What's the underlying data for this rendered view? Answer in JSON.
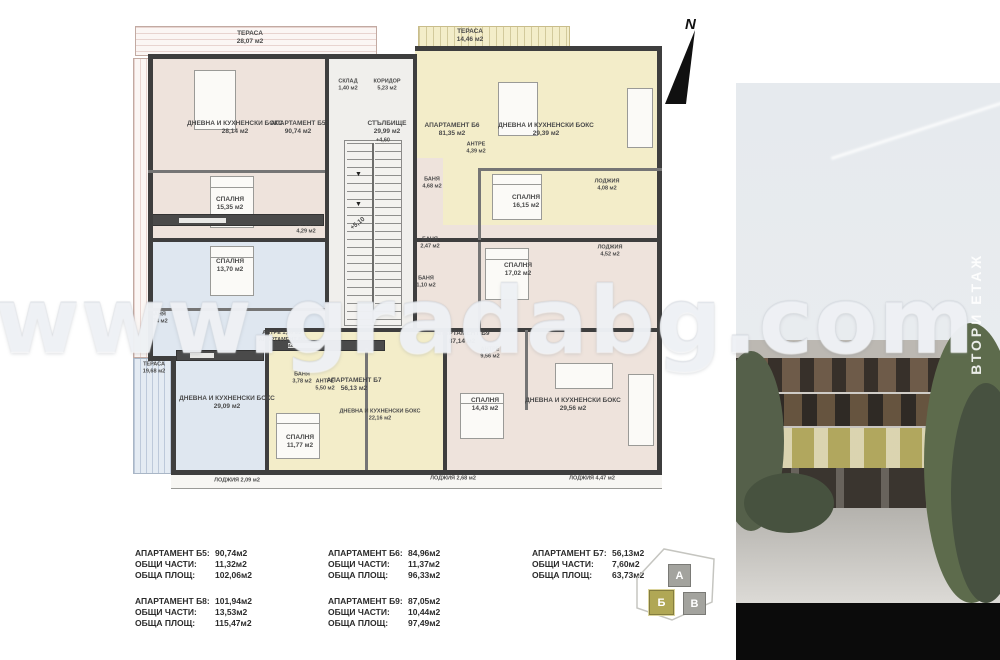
{
  "meta": {
    "compass_label": "N",
    "watermark": "www.gradabg.com",
    "floor_label": "ВТОРИ ЕТАЖ"
  },
  "plan": {
    "colors": {
      "pink": "#eee3dc",
      "yellow": "#f3edc9",
      "blue": "#dfe7f0",
      "core": "#f0efec",
      "wall": "#3e3e3e"
    },
    "zones": [
      {
        "x": 20,
        "y": 38,
        "w": 178,
        "h": 184,
        "fill": "#eee3dc"
      },
      {
        "x": 285,
        "y": 30,
        "w": 247,
        "h": 192,
        "fill": "#f3edc9"
      },
      {
        "x": 20,
        "y": 222,
        "w": 175,
        "h": 118,
        "fill": "#dfe7f0"
      },
      {
        "x": 44,
        "y": 340,
        "w": 91,
        "h": 112,
        "fill": "#dfe7f0"
      },
      {
        "x": 135,
        "y": 312,
        "w": 178,
        "h": 140,
        "fill": "#f3edc9"
      },
      {
        "x": 313,
        "y": 207,
        "w": 219,
        "h": 245,
        "fill": "#eee3dc"
      },
      {
        "x": 283,
        "y": 140,
        "w": 30,
        "h": 172,
        "fill": "#eee3dc"
      },
      {
        "x": 195,
        "y": 38,
        "w": 90,
        "h": 274,
        "fill": "#f0efec"
      }
    ],
    "terraces": [
      {
        "x": 5,
        "y": 8,
        "w": 240,
        "h": 28,
        "hatch": "pink-h"
      },
      {
        "x": 288,
        "y": 8,
        "w": 150,
        "h": 21,
        "hatch": "yellow"
      },
      {
        "x": 3,
        "y": 40,
        "w": 15,
        "h": 298,
        "hatch": "pink-v"
      },
      {
        "x": 3,
        "y": 340,
        "w": 38,
        "h": 114,
        "hatch": "blue"
      }
    ],
    "loggia_strip": {
      "x": 41,
      "y": 457,
      "w": 491,
      "h": 13
    },
    "walls": [
      {
        "x": 18,
        "y": 36,
        "w": 267,
        "h": 5
      },
      {
        "x": 285,
        "y": 28,
        "w": 247,
        "h": 5
      },
      {
        "x": 527,
        "y": 28,
        "w": 5,
        "h": 429
      },
      {
        "x": 41,
        "y": 452,
        "w": 491,
        "h": 5
      },
      {
        "x": 18,
        "y": 36,
        "w": 5,
        "h": 307
      },
      {
        "x": 41,
        "y": 338,
        "w": 5,
        "h": 119
      },
      {
        "x": 18,
        "y": 338,
        "w": 28,
        "h": 5
      },
      {
        "x": 195,
        "y": 36,
        "w": 4,
        "h": 276
      },
      {
        "x": 283,
        "y": 36,
        "w": 4,
        "h": 276
      },
      {
        "x": 18,
        "y": 220,
        "w": 181,
        "h": 4
      },
      {
        "x": 285,
        "y": 220,
        "w": 247,
        "h": 4
      },
      {
        "x": 135,
        "y": 310,
        "w": 397,
        "h": 4
      },
      {
        "x": 313,
        "y": 310,
        "w": 4,
        "h": 147
      },
      {
        "x": 135,
        "y": 310,
        "w": 4,
        "h": 147
      },
      {
        "x": 18,
        "y": 152,
        "w": 177,
        "h": 3,
        "thin": true
      },
      {
        "x": 18,
        "y": 290,
        "w": 177,
        "h": 3,
        "thin": true
      },
      {
        "x": 348,
        "y": 150,
        "w": 184,
        "h": 3,
        "thin": true
      },
      {
        "x": 348,
        "y": 150,
        "w": 3,
        "h": 72,
        "thin": true
      },
      {
        "x": 348,
        "y": 224,
        "w": 3,
        "h": 86,
        "thin": true
      },
      {
        "x": 395,
        "y": 312,
        "w": 3,
        "h": 80,
        "thin": true
      },
      {
        "x": 235,
        "y": 330,
        "w": 3,
        "h": 122,
        "thin": true
      }
    ],
    "stairs": {
      "x": 214,
      "y": 122,
      "w": 58,
      "h": 186
    },
    "furniture": [
      {
        "type": "bed",
        "x": 80,
        "y": 158,
        "w": 44,
        "h": 52
      },
      {
        "type": "bed",
        "x": 80,
        "y": 228,
        "w": 44,
        "h": 50
      },
      {
        "type": "bed",
        "x": 362,
        "y": 156,
        "w": 50,
        "h": 46
      },
      {
        "type": "bed",
        "x": 355,
        "y": 230,
        "w": 44,
        "h": 52
      },
      {
        "type": "bed",
        "x": 330,
        "y": 375,
        "w": 44,
        "h": 46
      },
      {
        "type": "bed",
        "x": 146,
        "y": 395,
        "w": 44,
        "h": 46
      },
      {
        "type": "table",
        "x": 64,
        "y": 52,
        "w": 42,
        "h": 60
      },
      {
        "type": "table",
        "x": 368,
        "y": 64,
        "w": 40,
        "h": 54
      },
      {
        "type": "table",
        "x": 425,
        "y": 345,
        "w": 58,
        "h": 26
      },
      {
        "type": "counter",
        "x": 22,
        "y": 196,
        "w": 172,
        "h": 12
      },
      {
        "type": "counter",
        "x": 46,
        "y": 332,
        "w": 88,
        "h": 11
      },
      {
        "type": "counter",
        "x": 140,
        "y": 322,
        "w": 115,
        "h": 11
      },
      {
        "type": "sofa",
        "x": 497,
        "y": 70,
        "w": 26,
        "h": 60
      },
      {
        "type": "sofa",
        "x": 498,
        "y": 356,
        "w": 26,
        "h": 72
      }
    ],
    "labels": [
      {
        "x": 120,
        "y": 20,
        "lines": [
          "ТЕРАСА",
          "28,07 м2"
        ]
      },
      {
        "x": 340,
        "y": 18,
        "lines": [
          "ТЕРАСА",
          "14,46 м2"
        ]
      },
      {
        "x": 24,
        "y": 350,
        "lines": [
          "ТЕРАСА",
          "19,68 м2"
        ],
        "size": 5.5
      },
      {
        "x": 105,
        "y": 110,
        "lines": [
          "ДНЕВНА И КУХНЕНСКИ БОКС",
          "28,14 м2"
        ]
      },
      {
        "x": 168,
        "y": 110,
        "lines": [
          "АПАРТАМЕНТ Б5",
          "90,74 м2"
        ]
      },
      {
        "x": 100,
        "y": 186,
        "lines": [
          "СПАЛНЯ",
          "15,35 м2"
        ]
      },
      {
        "x": 176,
        "y": 210,
        "lines": [
          "БАНЯ",
          "4,29 м2"
        ],
        "size": 5.5
      },
      {
        "x": 218,
        "y": 67,
        "lines": [
          "СКЛАД",
          "1,40 м2"
        ],
        "size": 5.5
      },
      {
        "x": 257,
        "y": 67,
        "lines": [
          "КОРИДОР",
          "5,23 м2"
        ],
        "size": 5.5
      },
      {
        "x": 257,
        "y": 110,
        "lines": [
          "СТЪЛБИЩЕ",
          "29,99 м2"
        ]
      },
      {
        "x": 253,
        "y": 123,
        "lines": [
          "+4,60"
        ],
        "size": 5.5
      },
      {
        "x": 228,
        "y": 206,
        "lines": [
          "+5,10"
        ],
        "rot": -38
      },
      {
        "x": 322,
        "y": 112,
        "lines": [
          "АПАРТАМЕНТ Б6",
          "81,35 м2"
        ]
      },
      {
        "x": 346,
        "y": 130,
        "lines": [
          "АНТРЕ",
          "4,39 м2"
        ],
        "size": 5.5
      },
      {
        "x": 416,
        "y": 112,
        "lines": [
          "ДНЕВНА И КУХНЕНСКИ БОКС",
          "29,39 м2"
        ]
      },
      {
        "x": 396,
        "y": 184,
        "lines": [
          "СПАЛНЯ",
          "16,15 м2"
        ]
      },
      {
        "x": 302,
        "y": 165,
        "lines": [
          "БАНЯ",
          "4,68 м2"
        ],
        "size": 5.5
      },
      {
        "x": 477,
        "y": 167,
        "lines": [
          "ЛОДЖИЯ",
          "4,08 м2"
        ],
        "size": 5.5
      },
      {
        "x": 388,
        "y": 252,
        "lines": [
          "СПАЛНЯ",
          "17,02 м2"
        ]
      },
      {
        "x": 480,
        "y": 233,
        "lines": [
          "ЛОДЖИЯ",
          "4,52 м2"
        ],
        "size": 5.5
      },
      {
        "x": 300,
        "y": 225,
        "lines": [
          "БАНЯ",
          "2,47 м2"
        ],
        "size": 5.5
      },
      {
        "x": 296,
        "y": 264,
        "lines": [
          "БАНЯ",
          "1,10 м2"
        ],
        "size": 5.5
      },
      {
        "x": 100,
        "y": 248,
        "lines": [
          "СПАЛНЯ",
          "13,70 м2"
        ]
      },
      {
        "x": 28,
        "y": 300,
        "lines": [
          "БАНЯ",
          "3,74 м2"
        ],
        "size": 5.5
      },
      {
        "x": 152,
        "y": 322,
        "lines": [
          "АНТРЕ 1,86 м2",
          "АПАРТАМЕНТ Б8",
          "84,94 м2"
        ],
        "size": 5.5
      },
      {
        "x": 97,
        "y": 385,
        "lines": [
          "ДНЕВНА И КУХНЕНСКИ БОКС",
          "29,09 м2"
        ]
      },
      {
        "x": 107,
        "y": 463,
        "lines": [
          "ЛОДЖИЯ 2,09 м2"
        ],
        "size": 5.5
      },
      {
        "x": 172,
        "y": 360,
        "lines": [
          "БАНЯ",
          "3,78 м2"
        ],
        "size": 5.5
      },
      {
        "x": 195,
        "y": 367,
        "lines": [
          "АНТРЕ",
          "5,50 м2"
        ],
        "size": 5.5
      },
      {
        "x": 224,
        "y": 367,
        "lines": [
          "АПАРТАМЕНТ Б7",
          "56,13 м2"
        ]
      },
      {
        "x": 250,
        "y": 397,
        "lines": [
          "ДНЕВНА И КУХНЕНСКИ БОКС",
          "22,16 м2"
        ],
        "size": 5.5
      },
      {
        "x": 170,
        "y": 424,
        "lines": [
          "СПАЛНЯ",
          "11,77 м2"
        ]
      },
      {
        "x": 323,
        "y": 461,
        "lines": [
          "ЛОДЖИЯ 2,68 м2"
        ],
        "size": 5.5
      },
      {
        "x": 332,
        "y": 320,
        "lines": [
          "АПАРТАМЕНТ Б9",
          "87,14 м2"
        ]
      },
      {
        "x": 360,
        "y": 335,
        "lines": [
          "АНТРЕ",
          "9,56 м2"
        ],
        "size": 5.5
      },
      {
        "x": 355,
        "y": 387,
        "lines": [
          "СПАЛНЯ",
          "14,43 м2"
        ]
      },
      {
        "x": 443,
        "y": 387,
        "lines": [
          "ДНЕВНА И КУХНЕНСКИ БОКС",
          "29,56 м2"
        ]
      },
      {
        "x": 462,
        "y": 461,
        "lines": [
          "ЛОДЖИЯ 4,47 м2"
        ],
        "size": 5.5
      }
    ]
  },
  "tables": [
    {
      "x": 135,
      "y": 548,
      "rows": [
        [
          "АПАРТАМЕНТ Б5:",
          "90,74м2"
        ],
        [
          "ОБЩИ ЧАСТИ:",
          "11,32м2"
        ],
        [
          "ОБЩА ПЛОЩ:",
          "102,06м2"
        ]
      ]
    },
    {
      "x": 328,
      "y": 548,
      "rows": [
        [
          "АПАРТАМЕНТ Б6:",
          "84,96м2"
        ],
        [
          "ОБЩИ ЧАСТИ:",
          "11,37м2"
        ],
        [
          "ОБЩА ПЛОЩ:",
          "96,33м2"
        ]
      ]
    },
    {
      "x": 532,
      "y": 548,
      "rows": [
        [
          "АПАРТАМЕНТ Б7:",
          "56,13м2"
        ],
        [
          "ОБЩИ ЧАСТИ:",
          "7,60м2"
        ],
        [
          "ОБЩА ПЛОЩ:",
          "63,73м2"
        ]
      ]
    },
    {
      "x": 135,
      "y": 596,
      "rows": [
        [
          "АПАРТАМЕНТ Б8:",
          "101,94м2"
        ],
        [
          "ОБЩИ ЧАСТИ:",
          "13,53м2"
        ],
        [
          "ОБЩА ПЛОЩ:",
          "115,47м2"
        ]
      ]
    },
    {
      "x": 328,
      "y": 596,
      "rows": [
        [
          "АПАРТАМЕНТ Б9:",
          "87,05м2"
        ],
        [
          "ОБЩИ ЧАСТИ:",
          "10,44м2"
        ],
        [
          "ОБЩА ПЛОЩ:",
          "97,49м2"
        ]
      ]
    }
  ],
  "site_diagram": {
    "blocks": [
      {
        "label": "А",
        "x": 38,
        "y": 18,
        "s": 21,
        "color": "#a3a39e",
        "highlight": false
      },
      {
        "label": "Б",
        "x": 19,
        "y": 44,
        "s": 23,
        "color": "#b0a755",
        "highlight": true
      },
      {
        "label": "В",
        "x": 53,
        "y": 46,
        "s": 21,
        "color": "#a3a39e",
        "highlight": false
      }
    ]
  }
}
